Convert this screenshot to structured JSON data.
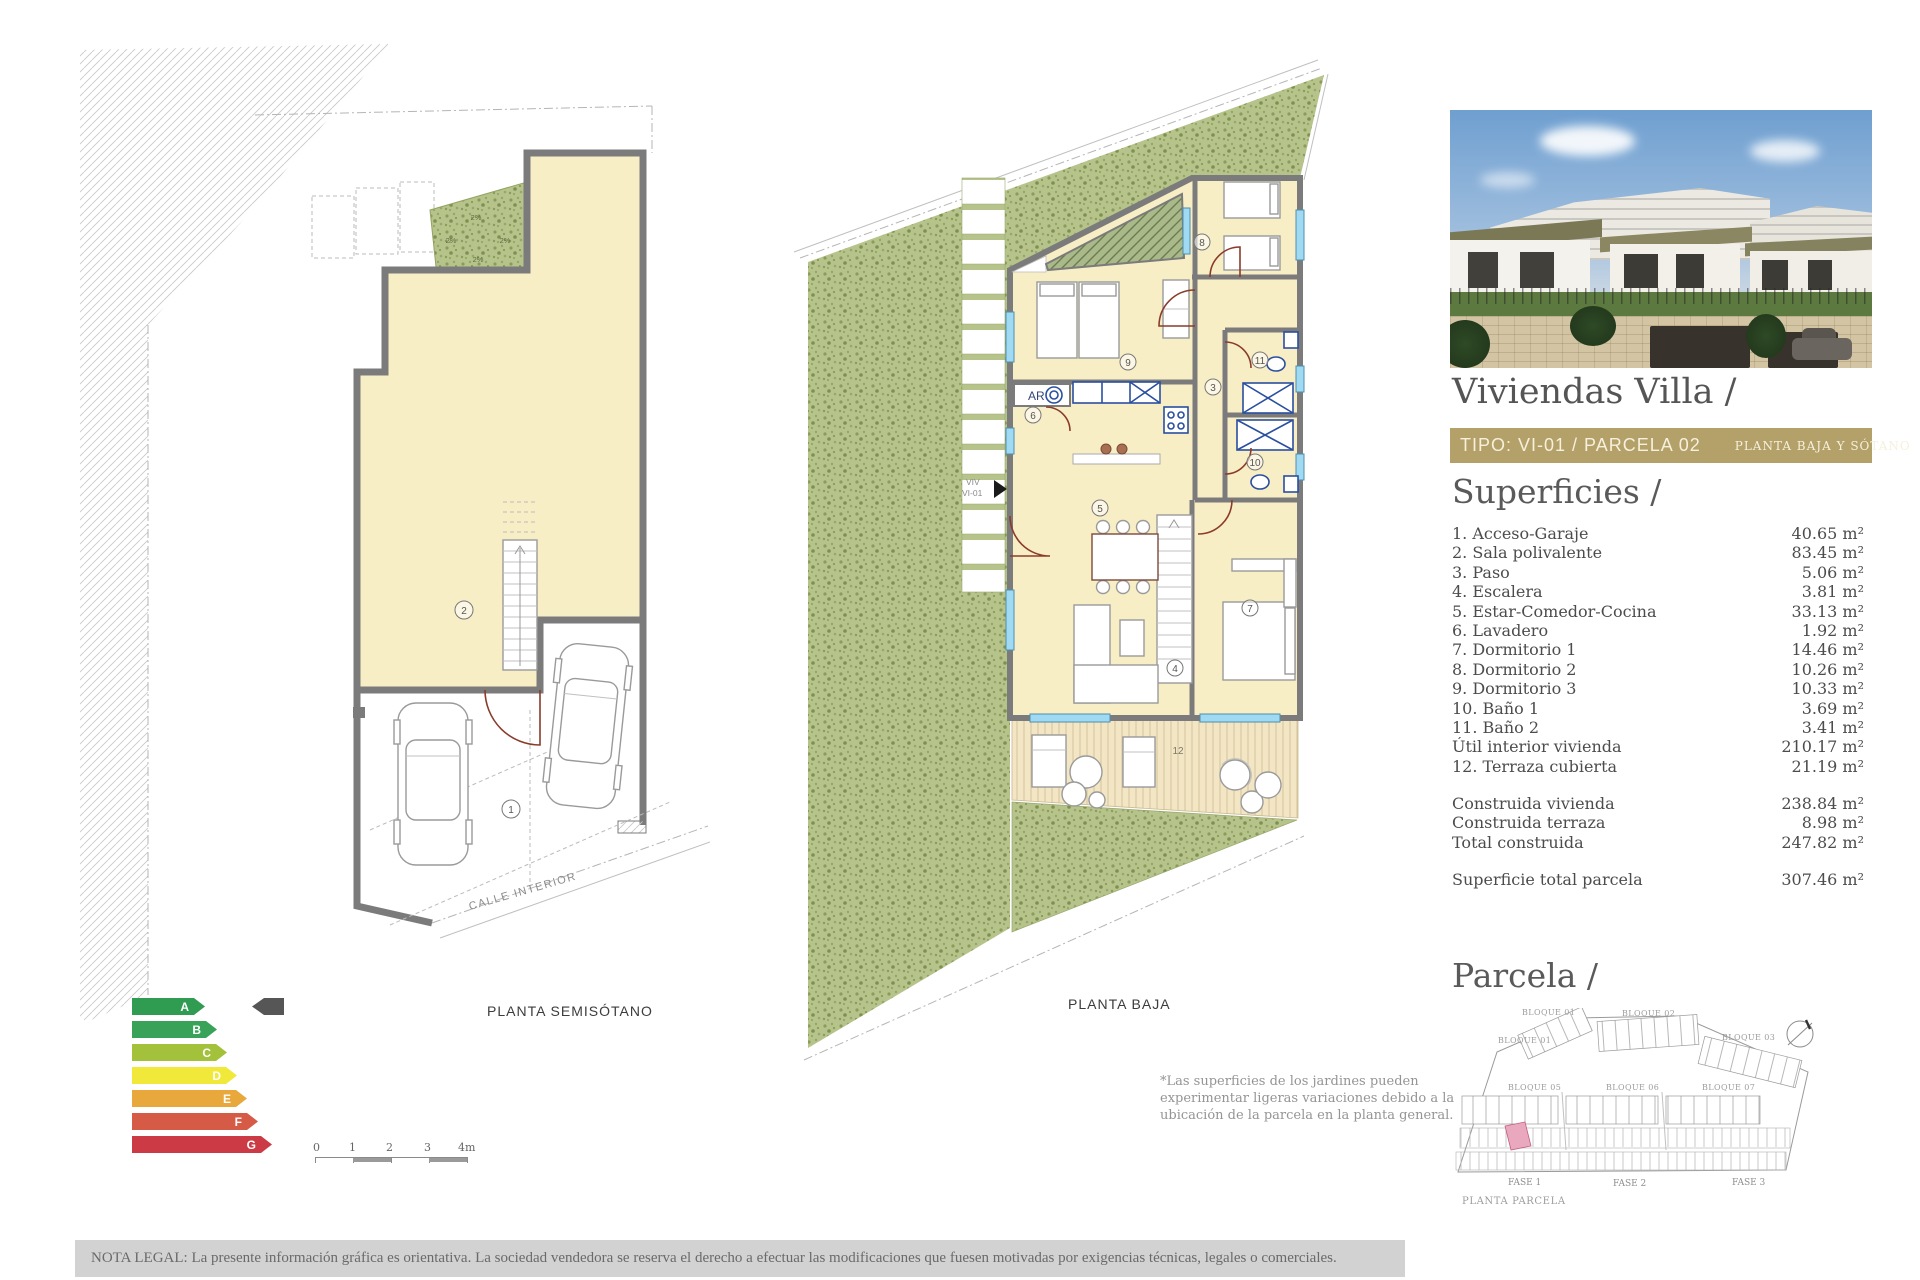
{
  "left_plan": {
    "label": "PLANTA SEMISÓTANO",
    "street_label": "CALLE INTERIOR",
    "rooms": {
      "garage": "1",
      "sala": "2"
    },
    "slope_labels": [
      "2%",
      "2%",
      "2%",
      "2%"
    ]
  },
  "middle_plan": {
    "label": "PLANTA BAJA",
    "entrance": {
      "line1": "VIV",
      "line2": "VI-01"
    },
    "closet_label": "AR",
    "rooms": {
      "r3": "3",
      "r4": "4",
      "r5": "5",
      "r6": "6",
      "r7": "7",
      "r8": "8",
      "r9": "9",
      "r10": "10",
      "r11": "11",
      "r12": "12"
    }
  },
  "energy_scale": {
    "rows": [
      {
        "letter": "A",
        "color": "#2f9c52",
        "width": 73
      },
      {
        "letter": "B",
        "color": "#37a258",
        "width": 85
      },
      {
        "letter": "C",
        "color": "#a3c13b",
        "width": 95
      },
      {
        "letter": "D",
        "color": "#f1e93a",
        "width": 105
      },
      {
        "letter": "E",
        "color": "#e8a83c",
        "width": 115
      },
      {
        "letter": "F",
        "color": "#d65b47",
        "width": 126
      },
      {
        "letter": "G",
        "color": "#cc3a45",
        "width": 140
      }
    ],
    "pointer_color": "#565656"
  },
  "scale_bar": {
    "ticks": [
      "0",
      "1",
      "2",
      "3",
      "4m"
    ]
  },
  "footnote": {
    "line1": "*Las superficies de los jardines pueden",
    "line2": "experimentar ligeras variaciones debido a la",
    "line3": "ubicación de la parcela en la planta general."
  },
  "panel": {
    "title": "Viviendas Villa /",
    "type_bar": {
      "main": "TIPO: VI-01 / PARCELA 02",
      "sub": "PLANTA BAJA Y SÓTANO",
      "bg": "#b3a169"
    },
    "superficies": {
      "heading": "Superficies /",
      "rows": [
        {
          "label": "1. Acceso-Garaje",
          "value": "40.65 m²"
        },
        {
          "label": "2. Sala polivalente",
          "value": "83.45 m²"
        },
        {
          "label": "3. Paso",
          "value": "5.06 m²"
        },
        {
          "label": "4. Escalera",
          "value": "3.81 m²"
        },
        {
          "label": "5. Estar-Comedor-Cocina",
          "value": "33.13 m²"
        },
        {
          "label": "6. Lavadero",
          "value": "1.92 m²"
        },
        {
          "label": "7. Dormitorio 1",
          "value": "14.46 m²"
        },
        {
          "label": "8. Dormitorio 2",
          "value": "10.26 m²"
        },
        {
          "label": "9. Dormitorio 3",
          "value": "10.33 m²"
        },
        {
          "label": "10. Baño 1",
          "value": "3.69 m²"
        },
        {
          "label": "11. Baño 2",
          "value": "3.41 m²"
        },
        {
          "label": "Útil interior vivienda",
          "value": "210.17 m²"
        },
        {
          "label": "12. Terraza cubierta",
          "value": "21.19 m²"
        }
      ],
      "totals": [
        {
          "label": "Construida vivienda",
          "value": "238.84 m²"
        },
        {
          "label": "Construida terraza",
          "value": "8.98 m²"
        },
        {
          "label": "Total construida",
          "value": "247.82 m²"
        }
      ],
      "parcel_total": {
        "label": "Superficie total parcela",
        "value": "307.46 m²"
      }
    },
    "parcela": {
      "heading": "Parcela /",
      "caption": "PLANTA PARCELA",
      "blocks": [
        "BLOQUE 01",
        "BLOQUE 02",
        "BLOQUE 01",
        "BLOQUE 03",
        "BLOQUE 05",
        "BLOQUE 06",
        "BLOQUE 07"
      ],
      "fases": [
        "FASE 1",
        "FASE 2",
        "FASE 3"
      ],
      "highlight_color": "#e9a8bd"
    }
  },
  "legal": "NOTA LEGAL: La presente información gráfica es orientativa. La sociedad vendedora se reserva el derecho a efectuar las modificaciones que fuesen motivadas por exigencias técnicas, legales o comerciales."
}
